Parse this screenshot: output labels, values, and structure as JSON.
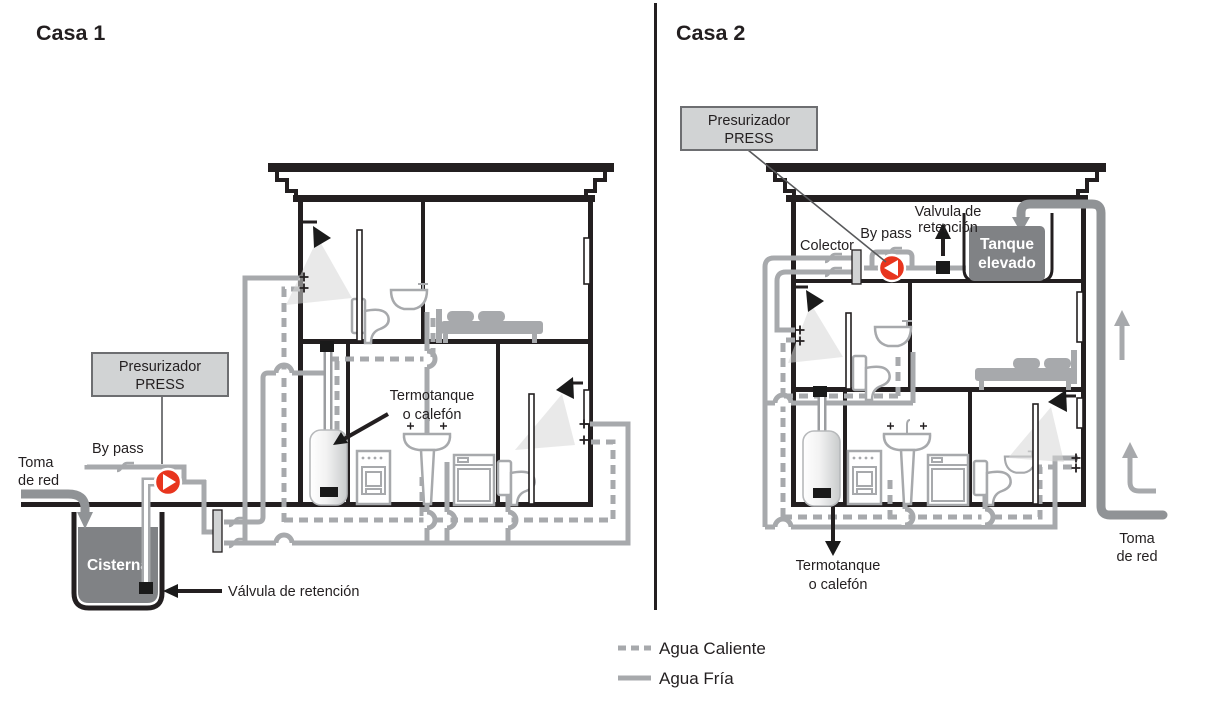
{
  "colors": {
    "pipe_gray": "#a7a9ac",
    "supply_gray": "#909396",
    "tank_gray": "#808285",
    "valve_red": "#e8351e",
    "box_fill": "#d1d3d4",
    "box_border": "#6d6e71",
    "line_black": "#231f20"
  },
  "casa1": {
    "title": "Casa 1",
    "presurizador": {
      "line1": "Presurizador",
      "line2": "PRESS"
    },
    "bypass": "By pass",
    "toma": {
      "line1": "Toma",
      "line2": "de red"
    },
    "cisterna": "Cisterna",
    "valvula_retencion": "Válvula de retención",
    "termotanque": {
      "line1": "Termotanque",
      "line2": "o calefón"
    }
  },
  "casa2": {
    "title": "Casa 2",
    "presurizador": {
      "line1": "Presurizador",
      "line2": "PRESS"
    },
    "colector": "Colector",
    "bypass": "By pass",
    "valvula_retencion": {
      "line1": "Valvula de",
      "line2": "retención"
    },
    "tanque_elevado": {
      "line1": "Tanque",
      "line2": "elevado"
    },
    "termotanque": {
      "line1": "Termotanque",
      "line2": "o calefón"
    },
    "toma": {
      "line1": "Toma",
      "line2": "de red"
    }
  },
  "legend": {
    "agua_caliente": "Agua Caliente",
    "agua_fria": "Agua Fría"
  }
}
